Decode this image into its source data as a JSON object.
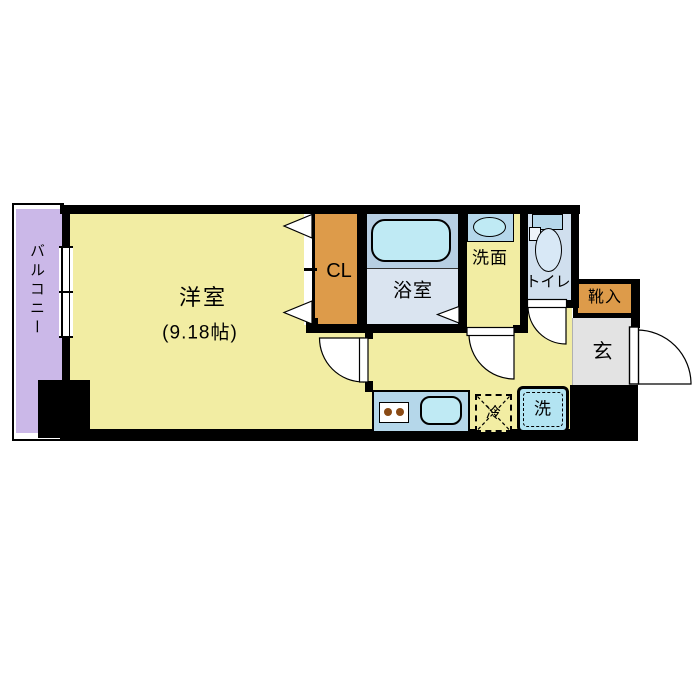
{
  "floorplan": {
    "rooms": {
      "balcony": {
        "label": "バルコニー"
      },
      "main_room": {
        "label": "洋室",
        "size": "(9.18帖)"
      },
      "closet": {
        "label": "CL"
      },
      "bathroom": {
        "label": "浴室"
      },
      "washroom": {
        "label": "洗面"
      },
      "toilet": {
        "label": "トイレ"
      },
      "shoe_box": {
        "label": "靴入"
      },
      "entrance": {
        "label": "玄"
      },
      "fridge": {
        "label": "冷"
      },
      "washer": {
        "label": "洗"
      }
    },
    "colors": {
      "floor_yellow": "#f2eda3",
      "balcony_purple": "#cbb8e8",
      "closet_orange": "#dd9b4a",
      "shoe_box_orange": "#dd9b4a",
      "fixture_blue": "#b5d7ea",
      "bath_lower_blue": "#dae4f0",
      "tub_cyan": "#bfeaf4",
      "toilet_blue": "#d0dfee",
      "entrance_gray": "#e3e3e3",
      "wall_black": "#000000",
      "burner_brown": "#8a4a14"
    }
  }
}
